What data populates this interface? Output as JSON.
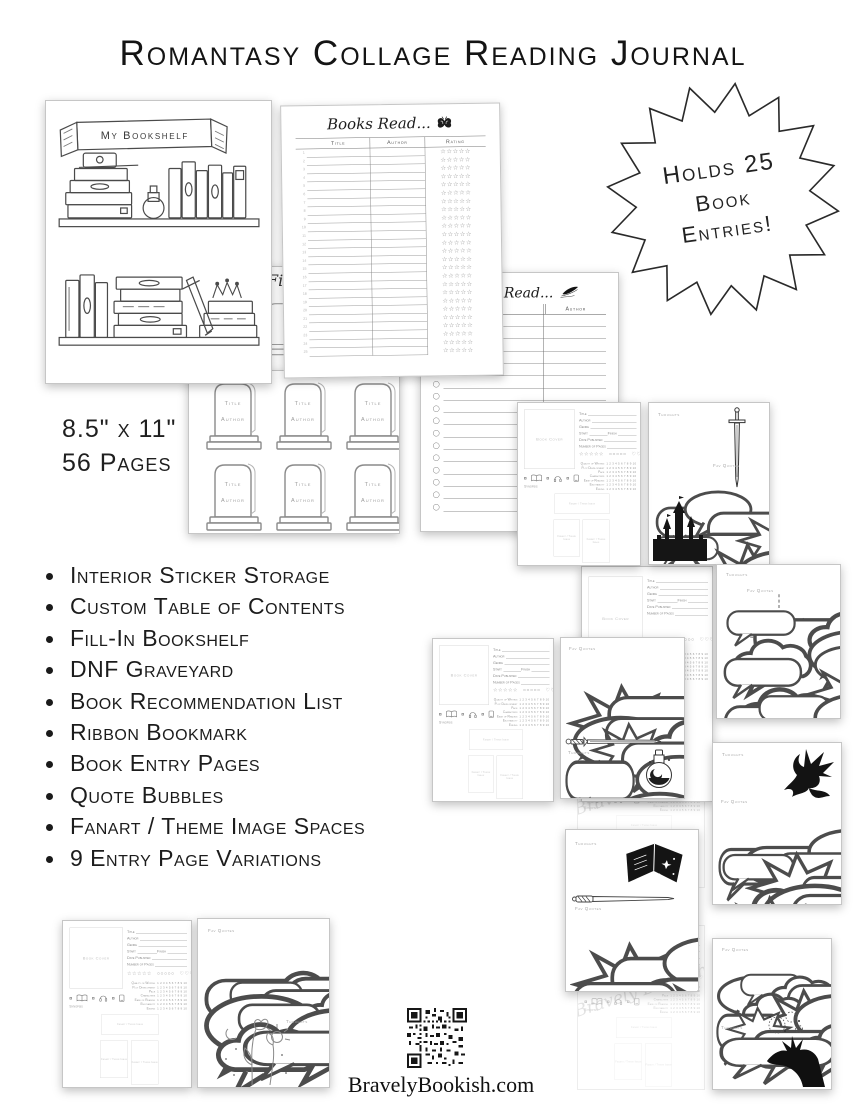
{
  "colors": {
    "ink": "#1a1a1a",
    "page_border": "#c6c6c6",
    "faint_text": "#9a9a9a"
  },
  "header": {
    "title": "Romantasy Collage Reading Journal"
  },
  "badge": {
    "line1": "Holds 25",
    "line2": "Book",
    "line3": "Entries!"
  },
  "specs": {
    "dimensions": "8.5\" x 11\"",
    "page_count": "56 Pages"
  },
  "features": [
    "Interior Sticker Storage",
    "Custom Table of Contents",
    "Fill-In Bookshelf",
    "DNF Graveyard",
    "Book Recommendation List",
    "Ribbon Bookmark",
    "Book Entry Pages",
    "Quote Bubbles",
    "Fanart / Theme Image Spaces",
    "9 Entry Page Variations"
  ],
  "footer": {
    "website": "BravelyBookish.com"
  },
  "previews": {
    "bookshelf": {
      "banner": "My Bookshelf"
    },
    "books_read": {
      "heading": "Books Read...",
      "col_title": "Title",
      "col_author": "Author",
      "col_rating": "Rating",
      "stars": "☆☆☆☆☆",
      "row_count": 25
    },
    "hidden_page": {
      "heading_fragment": "Fi"
    },
    "graveyard": {
      "title_label": "Title",
      "author_label": "Author",
      "stone_count": 6
    },
    "to_be_read": {
      "heading": "To Be Read...",
      "col_author": "Author",
      "row_count": 16
    },
    "entry": {
      "field_title": "Title",
      "field_author": "Author",
      "field_genre": "Genre",
      "field_start": "Start",
      "field_finish": "Finish",
      "field_date_published": "Date Published",
      "field_pages": "Number of Pages",
      "stars": "☆☆☆☆☆",
      "circles": "○○○○○",
      "hearts": "♡♡♡♡♡",
      "scale": "1 2 3 4 5 6 7 8 9 10",
      "categories": [
        "Quality of Writing",
        "Plot Development",
        "Pace",
        "Characters",
        "Ease of Reading",
        "Enjoyability",
        "Ending"
      ],
      "synopsis": "Synopsis",
      "book_cover": "Book Cover",
      "image_box": "Fanart / Theme Image"
    },
    "quotes": {
      "thoughts_label": "Thoughts",
      "fav_quotes_label": "Fav Quotes"
    },
    "watermark": "Bravely Bookish"
  }
}
